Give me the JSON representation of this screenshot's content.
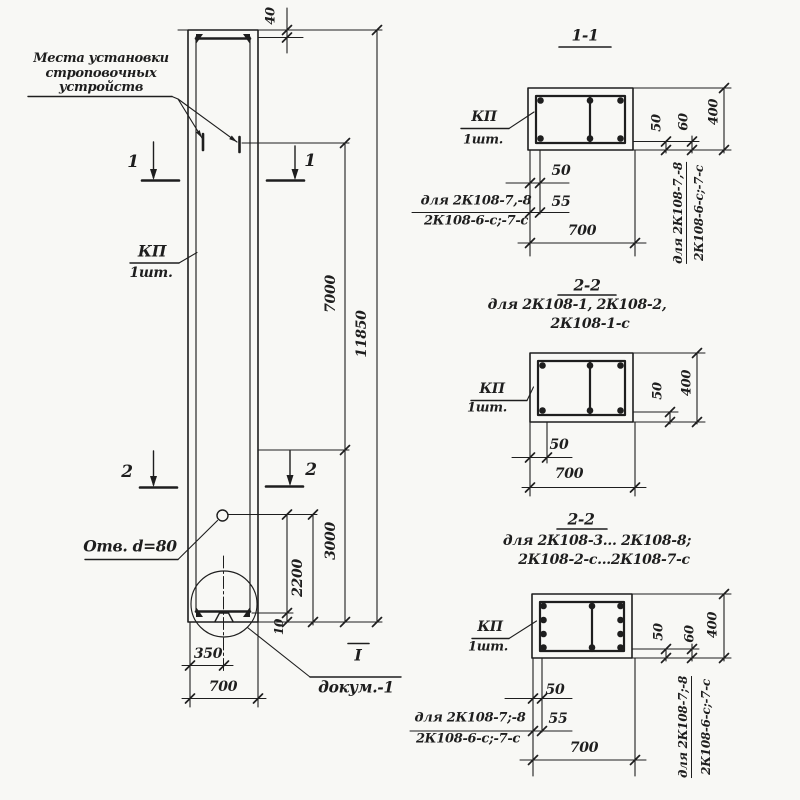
{
  "main": {
    "strop_note": "Места установки\nстроповочных\nустройств",
    "kp": "КП",
    "kp_qty": "1шт.",
    "hole_note": "Отв. d=80",
    "detail_mark": "I",
    "detail_ref": "докум.-1",
    "sec1": "1",
    "sec2": "2",
    "dim_40": "40",
    "dim_7000": "7000",
    "dim_11850": "11850",
    "dim_3000": "3000",
    "dim_2200": "2200",
    "dim_10": "10",
    "dim_350": "350",
    "dim_700": "700"
  },
  "s1": {
    "title": "1-1",
    "kp": "КП",
    "kp_qty": "1шт.",
    "dim_50": "50",
    "dim_55": "55",
    "dim_700": "700",
    "side_50": "50",
    "side_60": "60",
    "side_400": "400",
    "left_note1": "для 2К108-7,-8",
    "left_note2": "2К108-6-с;-7-с",
    "right_note1": "для 2К108-7,-8",
    "right_note2": "2К108-6-с;-7-с"
  },
  "s2": {
    "title": "2-2",
    "note1": "для 2К108-1, 2К108-2,",
    "note2": "2К108-1-с",
    "kp": "КП",
    "kp_qty": "1шт.",
    "dim_50": "50",
    "dim_700": "700",
    "side_50": "50",
    "side_400": "400"
  },
  "s3": {
    "title": "2-2",
    "note1": "для 2К108-3... 2К108-8;",
    "note2": "2К108-2-с...2К108-7-с",
    "kp": "КП",
    "kp_qty": "1шт.",
    "dim_50": "50",
    "dim_55": "55",
    "dim_700": "700",
    "side_50": "50",
    "side_60": "60",
    "side_400": "400",
    "left_note1": "для 2К108-7;-8",
    "left_note2": "2К108-6-с;-7-с",
    "right_note1": "для 2К108-7;-8",
    "right_note2": "2К108-6-с;-7-с"
  }
}
